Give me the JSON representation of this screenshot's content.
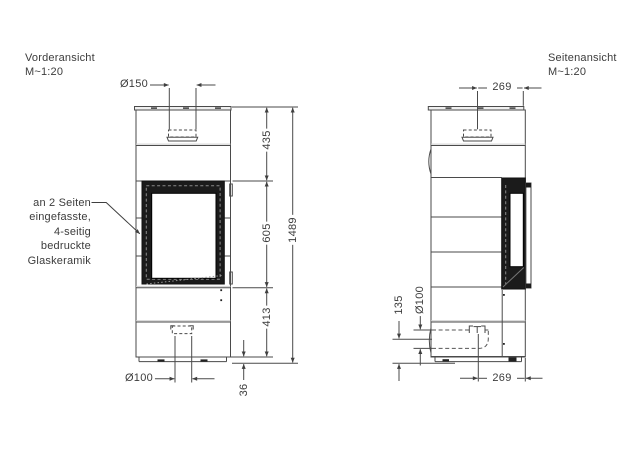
{
  "front": {
    "title": "Vorderansicht",
    "scale": "M~1:20",
    "flue_diameter": "Ø150",
    "upper_height": "435",
    "glass_height": "605",
    "lower_height": "413",
    "total_height": "1489",
    "plinth_height": "36",
    "air_inlet_diameter": "Ø100",
    "annotation": {
      "line1": "an 2 Seiten",
      "line2": "eingefasste,",
      "line3": "4-seitig",
      "line4": "bedruckte",
      "line5": "Glaskeramik"
    }
  },
  "side": {
    "title": "Seitenansicht",
    "scale": "M~1:20",
    "flue_offset": "269",
    "air_inlet_diameter": "Ø100",
    "air_inlet_height": "135",
    "front_offset": "269"
  },
  "colors": {
    "line": "#4a4a4a",
    "dark_fill": "#1b1b1b",
    "background": "#ffffff",
    "text": "#3c3c3c"
  }
}
